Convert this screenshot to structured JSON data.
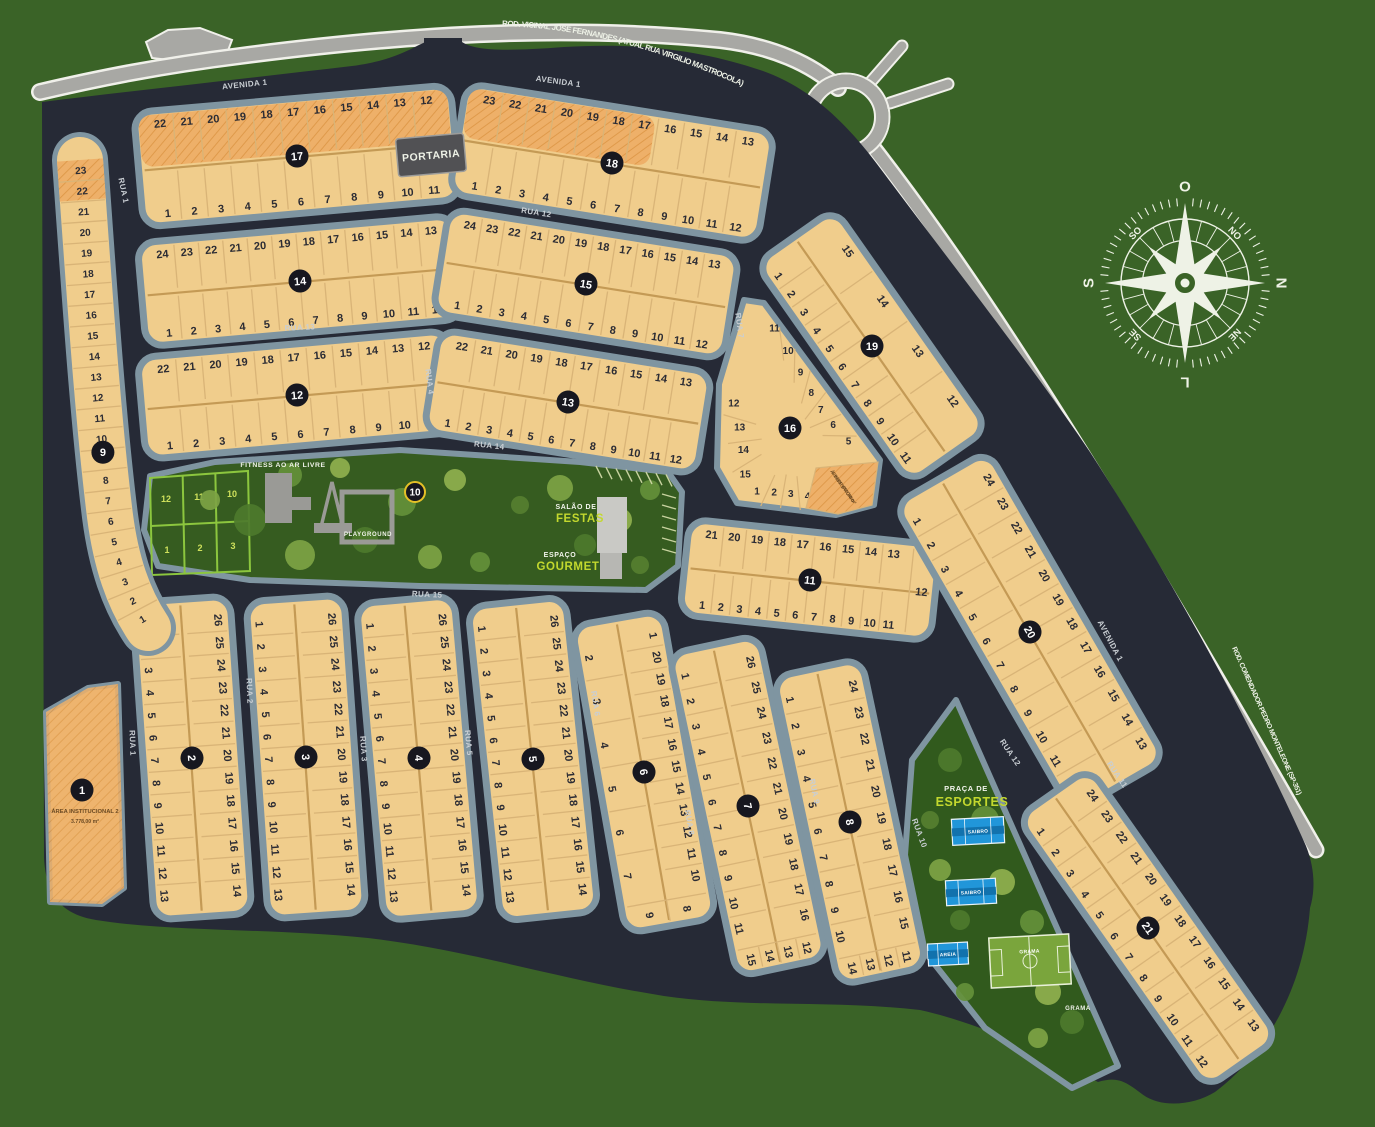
{
  "colors": {
    "background": "#3a6327",
    "interior": "#262a36",
    "road": "#a8a8a4",
    "road_casing": "#f0f0ea",
    "block_fill": "#f0cd8c",
    "block_border": "#7f95a1",
    "hatch_fill": "#eeb069",
    "hatch_line": "#df9a4b",
    "lot_line": "#d9b477",
    "lot_divider": "#c49a55",
    "badge_fill": "#17171f",
    "badge_gold": "#e5c027",
    "green_area": "#365c20",
    "praca_green": "#315a1d",
    "grid_green": "#8cc63e",
    "court_blue": "#2196d9",
    "court_band": "#1272ad",
    "field_green": "#7aa53c",
    "accent_yellow": "#c3d82e",
    "compass": "#eef2e6",
    "portaria_bg": "#515154",
    "building_gray": "#9a9a96"
  },
  "roads": {
    "top_label": "ROD. VICINAL JOSÉ FERNANDES (ATUAL RUA VIRGILIO MASTROCOLA)",
    "right_label": "ROD. COMENDADOR PEDRO MONTELEONE (SP-351)"
  },
  "portaria_label": "PORTARIA",
  "compass": {
    "top": "O",
    "right": "N",
    "bottom": "L",
    "left": "S",
    "top_left": "SO",
    "top_right": "NO",
    "bottom_right": "NE",
    "bottom_left": "SE"
  },
  "streets": [
    "AVENIDA 1",
    "AVENIDA 1",
    "RUA 12",
    "RUA 13",
    "RUA 4",
    "RUA 14",
    "RUA 15",
    "RUA 1",
    "RUA 1",
    "RUA 2",
    "RUA 3",
    "RUA 5",
    "RUA 6",
    "RUA 7",
    "RUA 8",
    "RUA 9",
    "RUA 10",
    "RUA 12",
    "RUA 11",
    "AVENIDA 1"
  ],
  "amenities": {
    "fitness": "FITNESS AO AR LIVRE",
    "playground": "PLAYGROUND",
    "salao_line1": "SALÃO DE",
    "salao_line2": "FESTAS",
    "espaco_line1": "ESPAÇO",
    "espaco_line2": "GOURMET",
    "praca_line1": "PRAÇA DE",
    "praca_line2": "ESPORTES",
    "courts": [
      "SAIBRO",
      "SAIBRO",
      "AREIA",
      "GRAMA"
    ],
    "grama_label": "GRAMA"
  },
  "area_institucional_2": {
    "badge": "1",
    "line1": "ÁREA INSTITUCIONAL 2",
    "line2": "3.778,00 m²"
  },
  "reservatorio": {
    "line1": "Á. INST. 1",
    "line2": "RESERVATÓRIO",
    "line3": "755,88 m²"
  },
  "blocks": [
    {
      "id": "17",
      "row_a": [
        "22",
        "21",
        "20",
        "19",
        "18",
        "17",
        "16",
        "15",
        "14",
        "13",
        "12"
      ],
      "row_b": [
        "1",
        "2",
        "3",
        "4",
        "5",
        "6",
        "7",
        "8",
        "9",
        "10",
        "11"
      ],
      "hatch": 1
    },
    {
      "id": "18",
      "row_a": [
        "23",
        "22",
        "21",
        "20",
        "19",
        "18",
        "17",
        "16",
        "15",
        "14",
        "13"
      ],
      "row_b": [
        "1",
        "2",
        "3",
        "4",
        "5",
        "6",
        "7",
        "8",
        "9",
        "10",
        "11",
        "12"
      ],
      "hatch": 0.62
    },
    {
      "id": "14",
      "row_a": [
        "24",
        "23",
        "22",
        "21",
        "20",
        "19",
        "18",
        "17",
        "16",
        "15",
        "14",
        "13"
      ],
      "row_b": [
        "1",
        "2",
        "3",
        "4",
        "5",
        "6",
        "7",
        "8",
        "9",
        "10",
        "11",
        "12"
      ]
    },
    {
      "id": "15",
      "row_a": [
        "24",
        "23",
        "22",
        "21",
        "20",
        "19",
        "18",
        "17",
        "16",
        "15",
        "14",
        "13"
      ],
      "row_b": [
        "1",
        "2",
        "3",
        "4",
        "5",
        "6",
        "7",
        "8",
        "9",
        "10",
        "11",
        "12"
      ]
    },
    {
      "id": "12",
      "row_a": [
        "22",
        "21",
        "20",
        "19",
        "18",
        "17",
        "16",
        "15",
        "14",
        "13",
        "12"
      ],
      "row_b": [
        "1",
        "2",
        "3",
        "4",
        "5",
        "6",
        "7",
        "8",
        "9",
        "10",
        "11"
      ]
    },
    {
      "id": "13",
      "row_a": [
        "22",
        "21",
        "20",
        "19",
        "18",
        "17",
        "16",
        "15",
        "14",
        "13"
      ],
      "row_b": [
        "1",
        "2",
        "3",
        "4",
        "5",
        "6",
        "7",
        "8",
        "9",
        "10",
        "11",
        "12"
      ]
    },
    {
      "id": "19",
      "row_a": [
        "15",
        "14",
        "13",
        "12"
      ],
      "row_b": [
        "1",
        "2",
        "3",
        "4",
        "5",
        "6",
        "7",
        "8",
        "9",
        "10",
        "11"
      ]
    },
    {
      "id": "11",
      "row_a": [
        "21",
        "20",
        "19",
        "18",
        "17",
        "16",
        "15",
        "14",
        "13"
      ],
      "row_b": [
        "1",
        "2",
        "3",
        "4",
        "5",
        "6",
        "7",
        "8",
        "9",
        "10",
        "11"
      ],
      "row_end": [
        "12"
      ]
    },
    {
      "id": "2",
      "row_a": [
        "26",
        "25",
        "24",
        "23",
        "22",
        "21",
        "20",
        "19",
        "18",
        "17",
        "16",
        "15",
        "14"
      ],
      "row_b": [
        "1",
        "2",
        "3",
        "4",
        "5",
        "6",
        "7",
        "8",
        "9",
        "10",
        "11",
        "12",
        "13"
      ]
    },
    {
      "id": "3",
      "row_a": [
        "26",
        "25",
        "24",
        "23",
        "22",
        "21",
        "20",
        "19",
        "18",
        "17",
        "16",
        "15",
        "14"
      ],
      "row_b": [
        "1",
        "2",
        "3",
        "4",
        "5",
        "6",
        "7",
        "8",
        "9",
        "10",
        "11",
        "12",
        "13"
      ]
    },
    {
      "id": "4",
      "row_a": [
        "26",
        "25",
        "24",
        "23",
        "22",
        "21",
        "20",
        "19",
        "18",
        "17",
        "16",
        "15",
        "14"
      ],
      "row_b": [
        "1",
        "2",
        "3",
        "4",
        "5",
        "6",
        "7",
        "8",
        "9",
        "10",
        "11",
        "12",
        "13"
      ]
    },
    {
      "id": "5",
      "row_a": [
        "26",
        "25",
        "24",
        "23",
        "22",
        "21",
        "20",
        "19",
        "18",
        "17",
        "16",
        "15",
        "14"
      ],
      "row_b": [
        "1",
        "2",
        "3",
        "4",
        "5",
        "6",
        "7",
        "8",
        "9",
        "10",
        "11",
        "12",
        "13"
      ]
    },
    {
      "id": "6",
      "row_a": [
        "1",
        "20",
        "19",
        "18",
        "17",
        "16",
        "15",
        "14",
        "13",
        "12",
        "11",
        "10"
      ],
      "row_b": [
        "2",
        "3",
        "4",
        "5",
        "6",
        "7"
      ],
      "row_end": [
        "8",
        "9"
      ]
    },
    {
      "id": "7",
      "row_a": [
        "26",
        "25",
        "24",
        "23",
        "22",
        "21",
        "20",
        "19",
        "18",
        "17",
        "16"
      ],
      "row_b": [
        "1",
        "2",
        "3",
        "4",
        "5",
        "6",
        "7",
        "8",
        "9",
        "10",
        "11"
      ],
      "row_end": [
        "12",
        "13",
        "14",
        "15"
      ]
    },
    {
      "id": "8",
      "row_a": [
        "24",
        "23",
        "22",
        "21",
        "20",
        "19",
        "18",
        "17",
        "16",
        "15"
      ],
      "row_b": [
        "1",
        "2",
        "3",
        "4",
        "5",
        "6",
        "7",
        "8",
        "9",
        "10"
      ],
      "row_end": [
        "11",
        "12",
        "13",
        "14"
      ]
    },
    {
      "id": "20",
      "row_a": [
        "24",
        "23",
        "22",
        "21",
        "20",
        "19",
        "18",
        "17",
        "16",
        "15",
        "14",
        "13"
      ],
      "row_b": [
        "1",
        "2",
        "3",
        "4",
        "5",
        "6",
        "7",
        "8",
        "9",
        "10",
        "11",
        "12"
      ]
    },
    {
      "id": "21",
      "row_a": [
        "24",
        "23",
        "22",
        "21",
        "20",
        "19",
        "18",
        "17",
        "16",
        "15",
        "14",
        "13"
      ],
      "row_b": [
        "1",
        "2",
        "3",
        "4",
        "5",
        "6",
        "7",
        "8",
        "9",
        "10",
        "11",
        "12"
      ]
    }
  ],
  "block9": {
    "id": "9",
    "lots": [
      "23",
      "22",
      "21",
      "20",
      "19",
      "18",
      "17",
      "16",
      "15",
      "14",
      "13",
      "12",
      "11",
      "10",
      "9",
      "8",
      "7",
      "6",
      "5",
      "4",
      "3",
      "2",
      "1"
    ]
  },
  "block10": {
    "id": "10",
    "grid_top": [
      "12",
      "11",
      "10"
    ],
    "grid_bottom": [
      "1",
      "2",
      "3"
    ]
  },
  "block16": {
    "id": "16",
    "right": [
      "11",
      "10",
      "9",
      "8",
      "7",
      "6",
      "5"
    ],
    "left": [
      "12",
      "13",
      "14",
      "15"
    ],
    "bottom": [
      "1",
      "2",
      "3",
      "4"
    ]
  }
}
